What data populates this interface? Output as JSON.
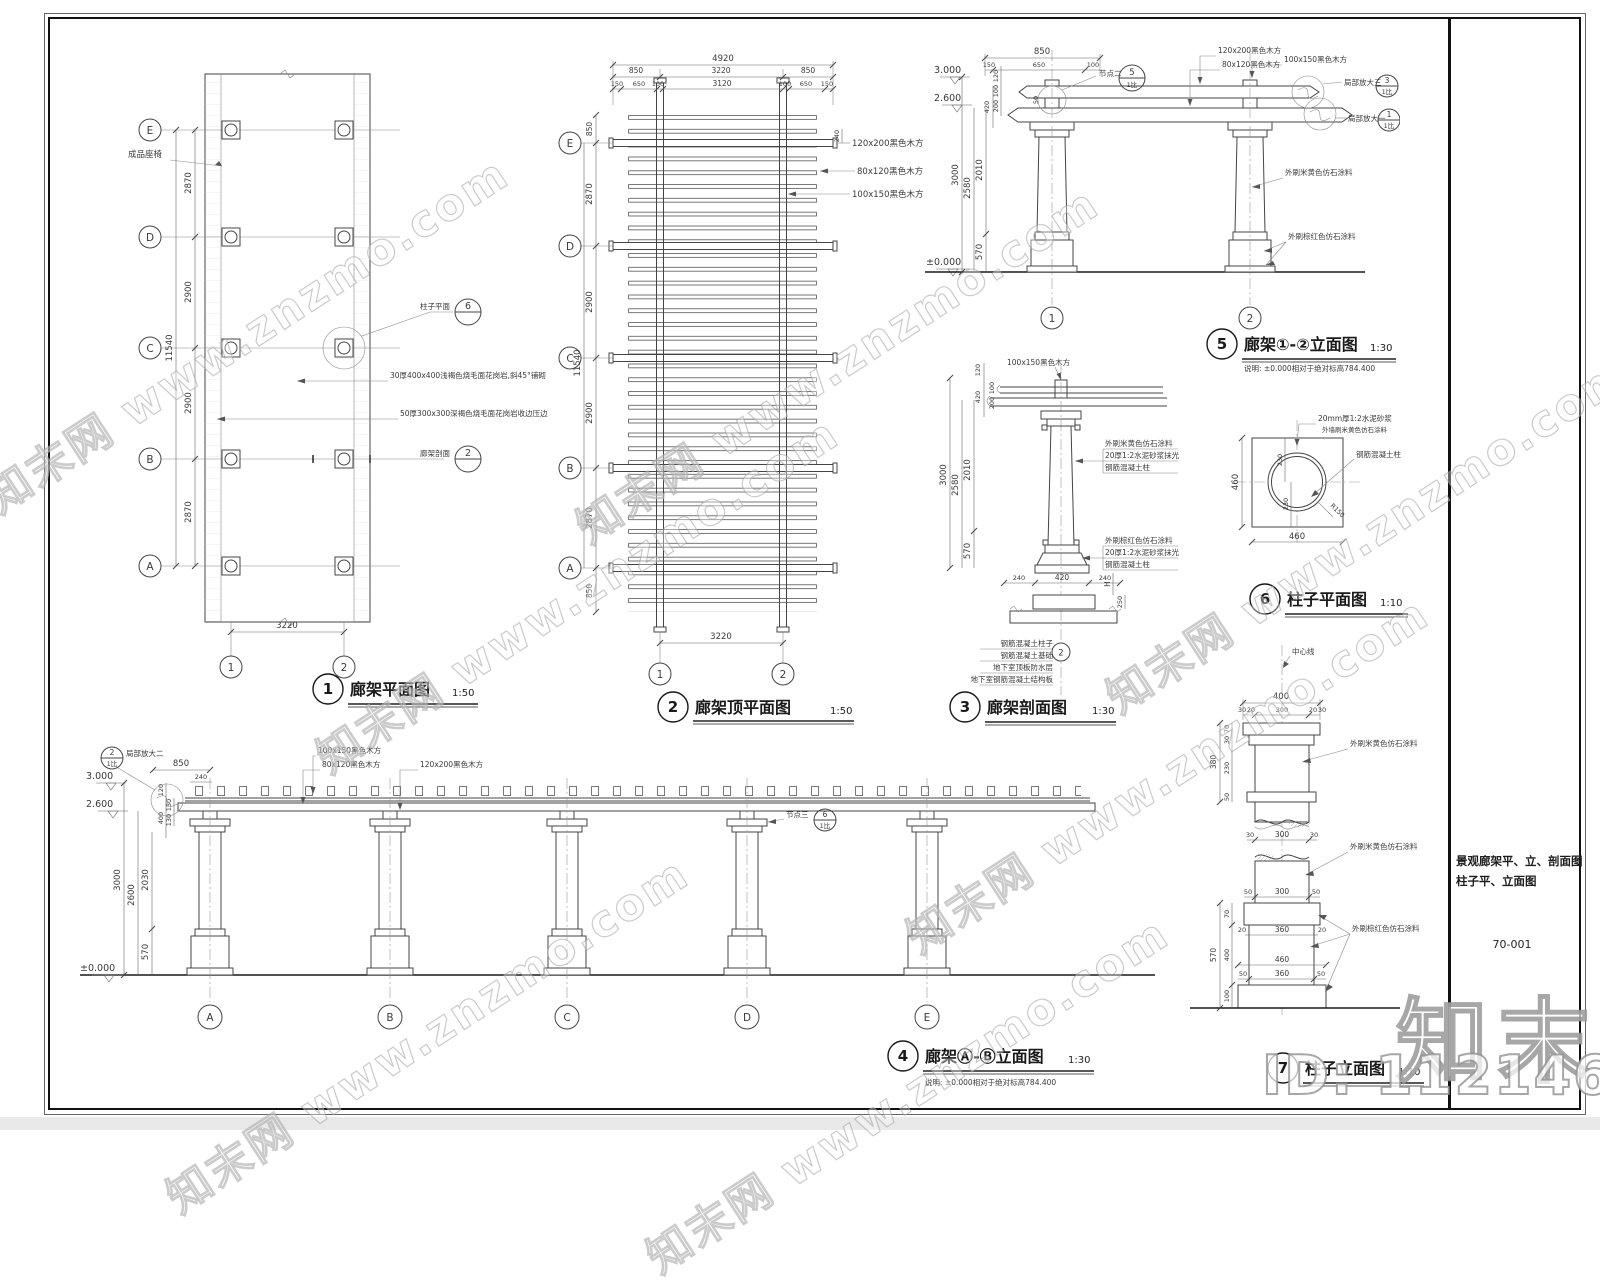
{
  "watermarks": {
    "diagonal": "知末网 www.znzmo.com",
    "logo": "知末",
    "id_label": "ID: 1121468420"
  },
  "sheet": {
    "title_line1": "景观廊架平、立、剖面图",
    "title_line2": "柱子平、立面图",
    "number": "70-001"
  },
  "note": "说明: ±0.000相对于绝对标高784.400",
  "materials": {
    "wood_120x200": "120x200黑色木方",
    "wood_80x120": "80x120黑色木方",
    "wood_100x150": "100x150黑色木方",
    "paint_beige": "外刷米黄色仿石涂料",
    "paint_beige_wall": "外墙刷米黄色仿石涂料",
    "paint_brown": "外刷棕红色仿石涂料",
    "mortar20": "20厚1:2水泥砂浆抹光",
    "mortar20mm": "20mm厚1:2水泥砂浆",
    "rc_col": "钢筋混凝土柱",
    "rc_col_full": "钢筋混凝土柱子",
    "rc_found": "钢筋混凝土基础",
    "bsmt_wp": "地下室顶板防水层",
    "bsmt_slab": "地下室钢筋混凝土结构板"
  },
  "levels": {
    "l3000": "3.000",
    "l2600": "2.600",
    "l0": "±0.000"
  },
  "d1": {
    "no": "1",
    "title": "廊架平面图",
    "scale": "1:50",
    "grid": [
      "E",
      "D",
      "C",
      "B",
      "A"
    ],
    "axes": [
      "1",
      "2"
    ],
    "v_total": "11540",
    "v1": "2870",
    "v2": "2900",
    "v3": "2900",
    "v4": "2870",
    "w": "3220",
    "bench": "成品座椅",
    "col_plan": "柱子平面",
    "col_plan_no": "6",
    "paving1": "30厚400x400浅褐色烧毛面花岗岩,斜45°铺砌",
    "paving2": "50厚300x300深褐色烧毛面花岗岩收边压边",
    "section_ref": "廊架剖面",
    "section_no": "2"
  },
  "d2": {
    "no": "2",
    "title": "廊架顶平面图",
    "scale": "1:50",
    "grid": [
      "E",
      "D",
      "C",
      "B",
      "A"
    ],
    "axes": [
      "1",
      "2"
    ],
    "w_total": "4920",
    "wa": "850",
    "wb": "3220",
    "wc": "850",
    "c1": "150",
    "c2": "650",
    "c3": "100",
    "c4": "3120",
    "c5": "100",
    "c6": "650",
    "c7": "150",
    "d240": "240",
    "v_top": "850",
    "v1": "2870",
    "v2": "2900",
    "v3": "2900",
    "v4": "2870",
    "v_bot": "850",
    "v_total": "11540",
    "w": "3220"
  },
  "d3": {
    "no": "3",
    "title": "廊架剖面图",
    "scale": "1:30",
    "axis": "2",
    "s120": "120",
    "s420": "420",
    "s200": "200",
    "s100": "100",
    "v3000": "3000",
    "v2580": "2580",
    "v2010": "2010",
    "v570": "570",
    "b240a": "240",
    "b420": "420",
    "b240b": "240",
    "bH": "H",
    "b250": "250"
  },
  "d5": {
    "no": "5",
    "title": "廊架①-②立面图",
    "scale": "1:30",
    "axes": [
      "1",
      "2"
    ],
    "w850": "850",
    "c150": "150",
    "c650": "650",
    "c100": "100",
    "d50": "50",
    "s120": "120",
    "s420": "420",
    "s100": "100",
    "s200": "200",
    "v3000": "3000",
    "v2580": "2580",
    "v2010": "2010",
    "v570": "570",
    "node2": "节点二",
    "node2_no": "5",
    "node2_sc": "1比",
    "det3": "局部放大三",
    "det3_no": "3",
    "det3_sc": "1比",
    "det1": "局部放大一",
    "det1_no": "1",
    "det1_sc": "1比"
  },
  "d6": {
    "no": "6",
    "title": "柱子平面图",
    "scale": "1:10",
    "d460l": "460",
    "d460b": "460",
    "d230a": "230",
    "d230b": "230",
    "r150": "R150"
  },
  "d4": {
    "no": "4",
    "title": "廊架Ⓐ-Ⓑ立面图",
    "scale": "1:30",
    "axes": [
      "A",
      "B",
      "C",
      "D",
      "E"
    ],
    "w850": "850",
    "w240": "240",
    "s120": "120",
    "s400": "400",
    "s150": "150",
    "s130": "130",
    "v3000": "3000",
    "v2600": "2600",
    "v2030": "2030",
    "v570": "570",
    "det2": "局部放大二",
    "det2_no": "2",
    "det2_sc": "1比",
    "node3": "节点三",
    "node3_no": "6",
    "node3_sc": "1比"
  },
  "d7": {
    "no": "7",
    "title": "柱子立面图",
    "scale": "1:10",
    "centerline": "中心线",
    "t400": "400",
    "t30a": "30",
    "t20a": "20",
    "t300": "300",
    "t20b": "20",
    "t30b": "30",
    "l380": "380",
    "l70": "70",
    "l30": "30",
    "l230": "230",
    "l50": "50",
    "m30a": "30",
    "m300": "300",
    "m30b": "30",
    "n50a": "50",
    "n300": "300",
    "n50b": "50",
    "p20a": "20",
    "p360": "360",
    "p20b": "20",
    "q570": "570",
    "q70": "70",
    "q400": "400",
    "q100": "100",
    "r460": "460",
    "r50a": "50",
    "r360": "360",
    "r50b": "50"
  }
}
